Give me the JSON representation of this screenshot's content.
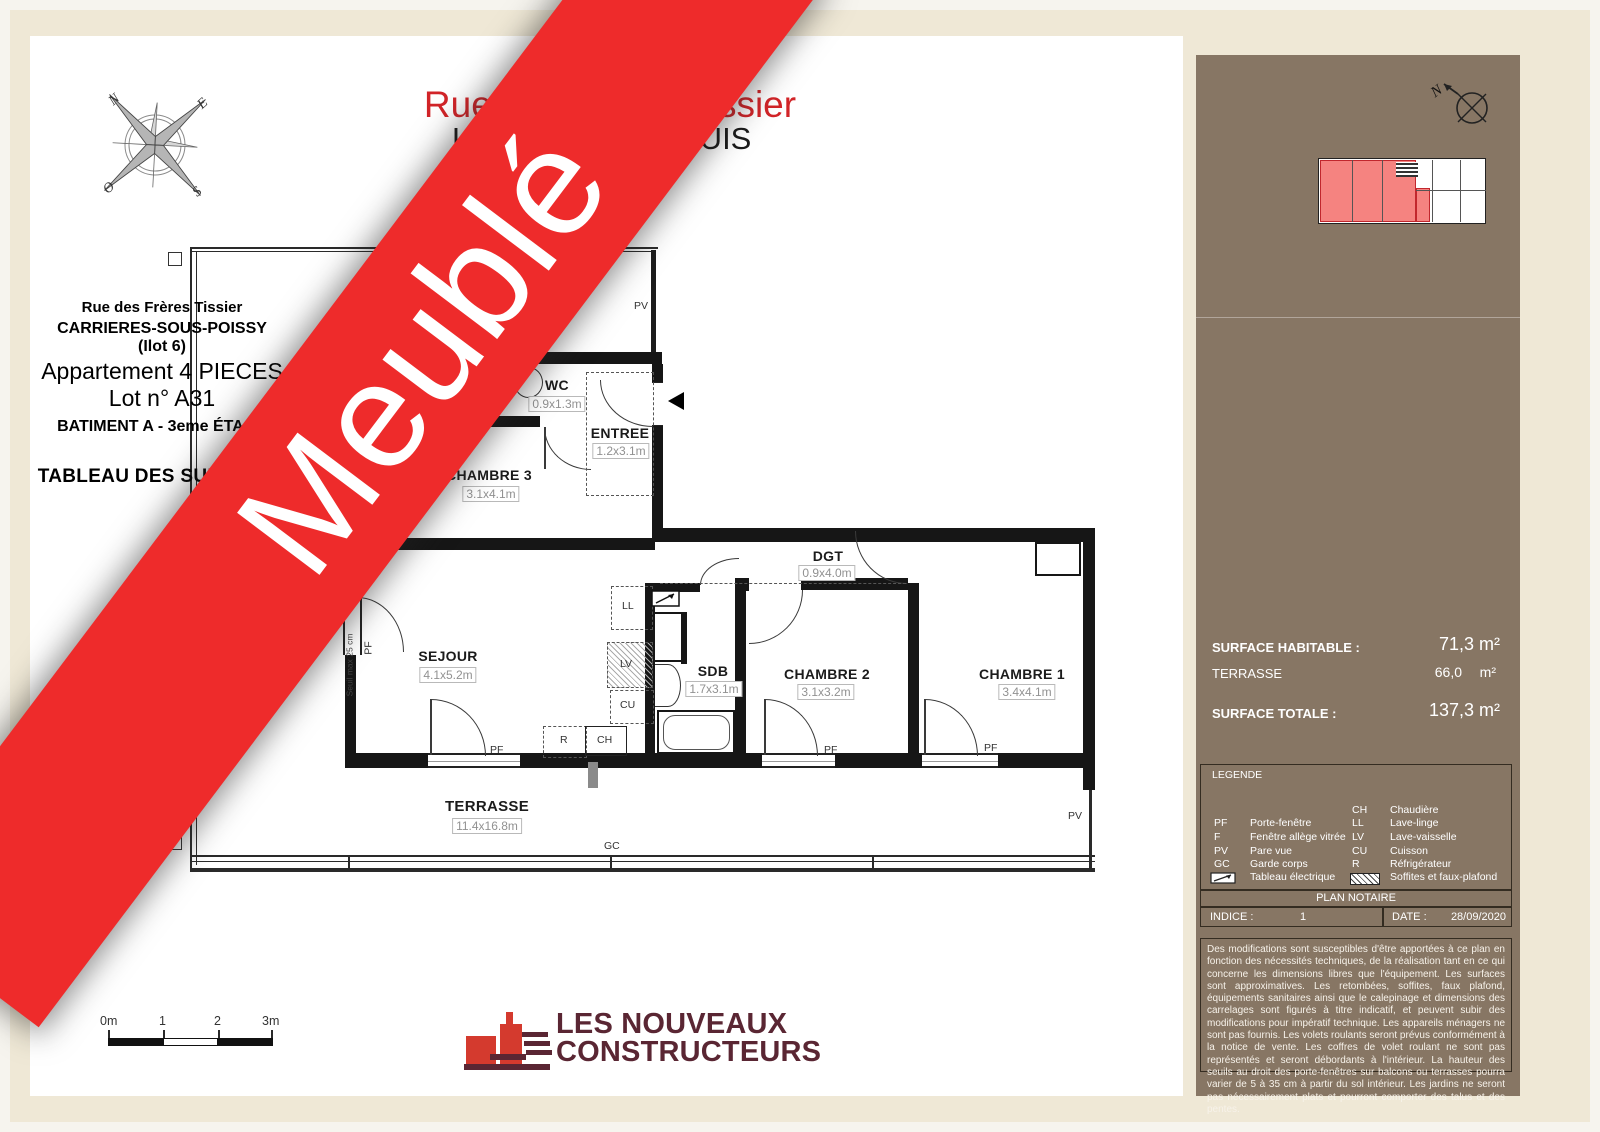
{
  "banner": {
    "text": "Meublé"
  },
  "header": {
    "title": "Rue des Frères Tissier",
    "subtitle_left": "LE",
    "subtitle_right": "-LOUIS"
  },
  "compass": {
    "n": "N",
    "e": "E",
    "s": "S",
    "w": "O"
  },
  "plan": {
    "rooms": {
      "wc": {
        "name": "WC",
        "dims": "0.9x1.3m"
      },
      "entree": {
        "name": "ENTREE",
        "dims": "1.2x3.1m"
      },
      "chambre3": {
        "name": "CHAMBRE 3",
        "dims": "3.1x4.1m"
      },
      "dgt": {
        "name": "DGT",
        "dims": "0.9x4.0m"
      },
      "sejour": {
        "name": "SEJOUR",
        "dims": "4.1x5.2m"
      },
      "sdb": {
        "name": "SDB",
        "dims": "1.7x3.1m"
      },
      "chambre2": {
        "name": "CHAMBRE 2",
        "dims": "3.1x3.2m"
      },
      "chambre1": {
        "name": "CHAMBRE 1",
        "dims": "3.4x4.1m"
      },
      "terrasse": {
        "name": "TERRASSE",
        "dims": "11.4x16.8m"
      }
    },
    "labels": {
      "pf": "PF",
      "pv": "PV",
      "gc": "GC",
      "ll": "LL",
      "lv": "LV",
      "cu": "CU",
      "r": "R",
      "ch": "CH",
      "seuil": "Seuil max 25 cm"
    }
  },
  "scalebar": {
    "t0": "0m",
    "t1": "1",
    "t2": "2",
    "t3": "3m"
  },
  "logo": {
    "line1": "LES NOUVEAUX",
    "line2": "CONSTRUCTEURS"
  },
  "sidebar": {
    "street": "Rue des Frères Tissier",
    "city": "CARRIERES-SOUS-POISSY",
    "ilot": "(Ilot 6)",
    "apartment": "Appartement 4 PIECES",
    "lot": "Lot n° A31",
    "building": "BATIMENT A - 3eme ÉTAGE",
    "surfaces_title": "TABLEAU DES SURFACES",
    "surface_rows": [
      {
        "label": "ENTREE",
        "value": "3,9",
        "unit": "m²"
      },
      {
        "label": "SEJOUR",
        "value": "21,8",
        "unit": "m²"
      },
      {
        "label": "CHAMBRE 1",
        "value": "14,7",
        "unit": "m²"
      },
      {
        "label": "CHAMBRE 2",
        "value": "10,4",
        "unit": "m²"
      },
      {
        "label": "CHAMBRE 3",
        "value": "11,2",
        "unit": "m²"
      },
      {
        "label": "SALLE DE BAIN",
        "value": "4,5",
        "unit": "m²"
      },
      {
        "label": "WC",
        "value": "1,2",
        "unit": "m²"
      },
      {
        "label": "DEGAGEMENT",
        "value": "3,6",
        "unit": "m²"
      }
    ],
    "habitable_label": "SURFACE HABITABLE :",
    "habitable_value": "71,3 m²",
    "terrasse_label": "TERRASSE",
    "terrasse_value": "66,0",
    "terrasse_unit": "m²",
    "totale_label": "SURFACE TOTALE :",
    "totale_value": "137,3 m²",
    "legend": {
      "title": "LEGENDE",
      "left": [
        {
          "abbr": "PF",
          "label": "Porte-fenêtre"
        },
        {
          "abbr": "F",
          "label": "Fenêtre allège vitrée"
        },
        {
          "abbr": "PV",
          "label": "Pare vue"
        },
        {
          "abbr": "GC",
          "label": "Garde corps"
        }
      ],
      "tableau_label": "Tableau électrique",
      "right": [
        {
          "abbr": "CH",
          "label": "Chaudière"
        },
        {
          "abbr": "LL",
          "label": "Lave-linge"
        },
        {
          "abbr": "LV",
          "label": "Lave-vaisselle"
        },
        {
          "abbr": "CU",
          "label": "Cuisson"
        },
        {
          "abbr": "R",
          "label": "Réfrigérateur"
        }
      ],
      "soffites_label": "Soffites et faux-plafond"
    },
    "notaire_bar": "PLAN NOTAIRE",
    "indice_label": "INDICE :",
    "indice_value": "1",
    "date_label": "DATE :",
    "date_value": "28/09/2020",
    "disclaimer": "Des modifications sont susceptibles d'être apportées à ce plan en fonction des nécessités techniques, de la réalisation tant en ce qui concerne les dimensions libres que l'équipement. Les surfaces sont approximatives. Les retombées, soffites, faux plafond, équipements sanitaires ainsi que le calepinage et dimensions des carrelages sont figurés à titre indicatif, et peuvent subir des modifications pour impératif technique. Les appareils ménagers ne sont pas fournis. Les volets roulants seront prévus conformément à la notice de vente. Les coffres de volet roulant ne sont pas représentés et seront débordants à l'intérieur. La hauteur des seuils au droit des porte-fenêtres sur balcons ou terrasses pourra varier de 5 à 35 cm à partir du sol intérieur. Les jardins ne seront pas nécessairement plats et pourront comporter des talus et des pentes."
  }
}
